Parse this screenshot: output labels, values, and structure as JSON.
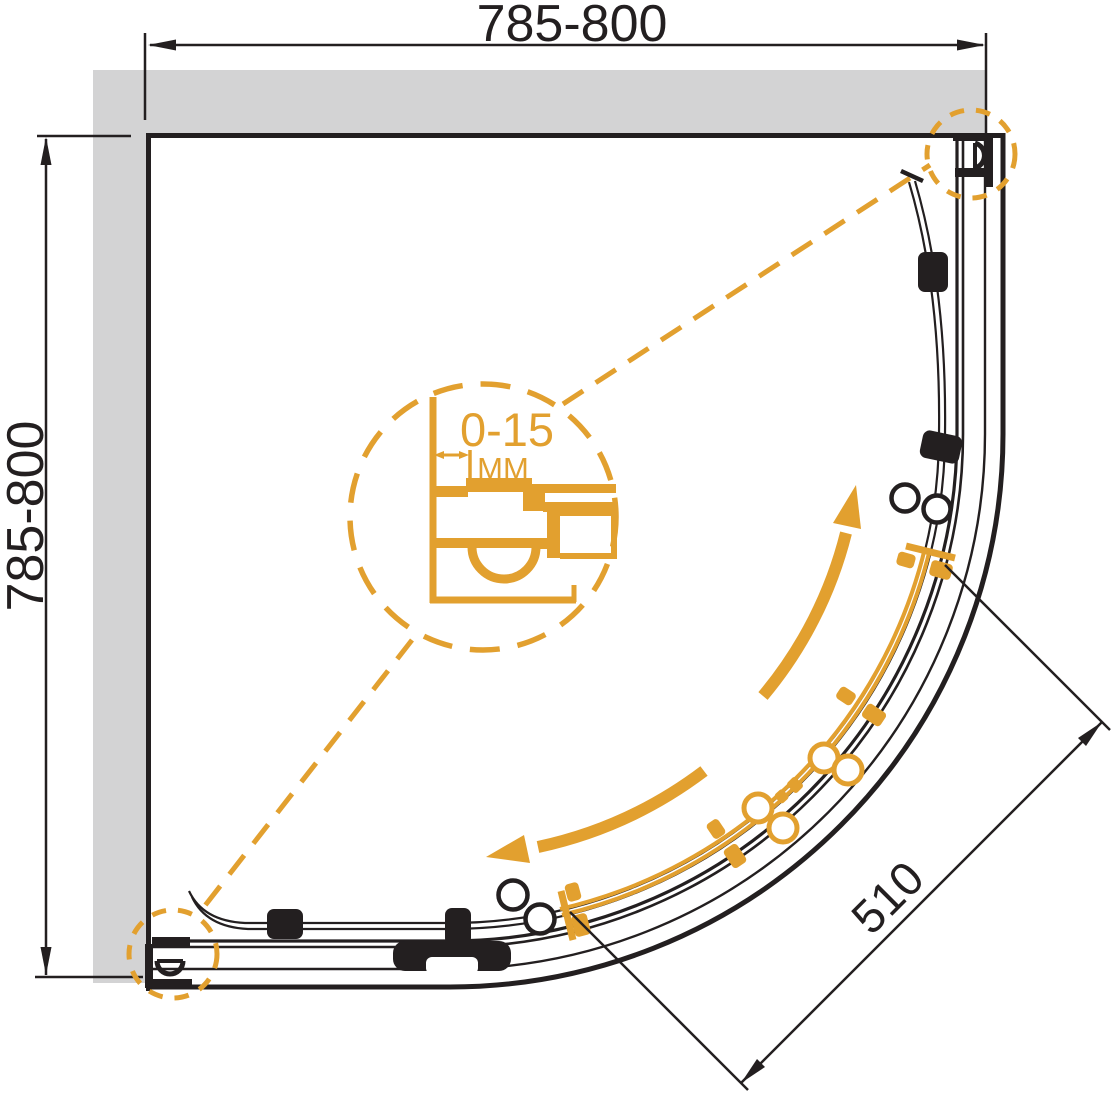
{
  "meta": {
    "drawing_type": "technical plan drawing",
    "subject": "quadrant corner shower enclosure with curved sliding doors, top view"
  },
  "labels": {
    "width_top": "785-800",
    "depth_left": "785-800",
    "door_opening": "510",
    "detail_range": "0-15",
    "detail_unit": "MM"
  },
  "colors": {
    "line": "#231f20",
    "accent": "#e2a02f",
    "wall_fill": "#d3d3d4",
    "background": "#ffffff"
  },
  "components": {
    "walls": "L-shaped wall band top and left",
    "frame": "quarter-circle track and frame rails",
    "fixed_panels": "black glass panels with rollers and knobs",
    "sliding_door": "orange highlighted curved sliding door with rollers and knobs",
    "direction_arrows": "two curved arrows showing sliding directions",
    "detail_view": "magnified wall-profile adjustment detail 0-15 MM",
    "detail_markers": "dashed circles at both wall profiles linked by dashed leaders"
  }
}
